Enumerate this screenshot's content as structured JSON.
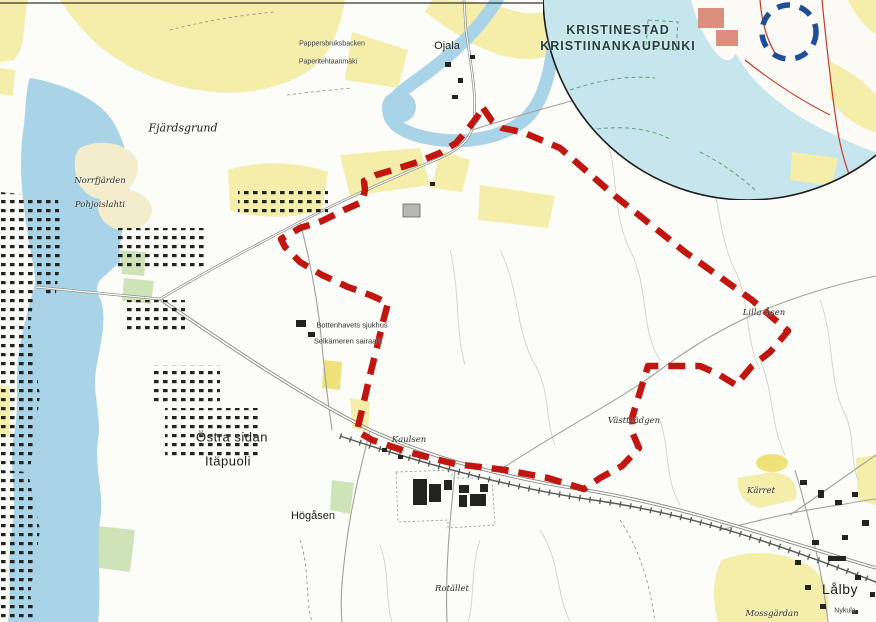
{
  "map": {
    "colors": {
      "paper": "#fcfcf9",
      "water": "#a9d3e6",
      "inset_water": "#c6e5ed",
      "field": "#f5edaa",
      "park": "#cfe3b8",
      "boundary_red": "#c0160f",
      "marker_blue": "#1e4e9a"
    },
    "inset": {
      "title_line1": "KRISTINESTAD",
      "title_line2": "KRISTIINANKAUPUNKI"
    },
    "labels": [
      {
        "id": "fjardsgrund",
        "text": "Fjärdsgrund",
        "x": 183,
        "y": 128,
        "cls": "nature"
      },
      {
        "id": "pappersbruksbacken",
        "text": "Pappersbruksbacken",
        "x": 332,
        "y": 44,
        "cls": "tiny"
      },
      {
        "id": "paperitehtaanmaki",
        "text": "Paperitehtaanmäki",
        "x": 328,
        "y": 62,
        "cls": "tiny"
      },
      {
        "id": "ojala",
        "text": "Ojala",
        "x": 447,
        "y": 46,
        "cls": "place"
      },
      {
        "id": "norrfjarden",
        "text": "Norrfjärden",
        "x": 100,
        "y": 181,
        "cls": "nature-sm"
      },
      {
        "id": "pohjoislahti",
        "text": "Pohjoislahti",
        "x": 100,
        "y": 205,
        "cls": "nature-sm"
      },
      {
        "id": "sjukhus-sv",
        "text": "Bottenhavets sjukhus",
        "x": 352,
        "y": 325,
        "cls": "small"
      },
      {
        "id": "sjukhus-fi",
        "text": "Selkämeren sairaala",
        "x": 348,
        "y": 341,
        "cls": "small"
      },
      {
        "id": "ostra-sidan",
        "text": "Östra sidan",
        "x": 232,
        "y": 437,
        "cls": "place-lg"
      },
      {
        "id": "itapuoli",
        "text": "Itäpuoli",
        "x": 228,
        "y": 461,
        "cls": "place-lg"
      },
      {
        "id": "kaulsen",
        "text": "Kaulsen",
        "x": 409,
        "y": 440,
        "cls": "nature-sm"
      },
      {
        "id": "vasttradgen",
        "text": "Västträdgen",
        "x": 634,
        "y": 421,
        "cls": "nature-sm"
      },
      {
        "id": "lilla-asen",
        "text": "Lilla Åsen",
        "x": 764,
        "y": 313,
        "cls": "nature-sm"
      },
      {
        "id": "hogasen",
        "text": "Högåsen",
        "x": 313,
        "y": 516,
        "cls": "place"
      },
      {
        "id": "karret",
        "text": "Kärret",
        "x": 761,
        "y": 491,
        "cls": "nature-sm"
      },
      {
        "id": "rotallet",
        "text": "Rotället",
        "x": 452,
        "y": 589,
        "cls": "nature-sm"
      },
      {
        "id": "lalby",
        "text": "Lålby",
        "x": 840,
        "y": 589,
        "cls": "place-xl"
      },
      {
        "id": "nykula",
        "text": "Nykula",
        "x": 845,
        "y": 611,
        "cls": "tiny"
      },
      {
        "id": "mossgardan",
        "text": "Mossgärdan",
        "x": 772,
        "y": 614,
        "cls": "nature-sm"
      },
      {
        "id": "inset-title-1",
        "text": "KRISTINESTAD",
        "x": 618,
        "y": 30,
        "cls": "inset-title"
      },
      {
        "id": "inset-title-2",
        "text": "KRISTIINANKAUPUNKI",
        "x": 618,
        "y": 46,
        "cls": "inset-title"
      }
    ]
  }
}
